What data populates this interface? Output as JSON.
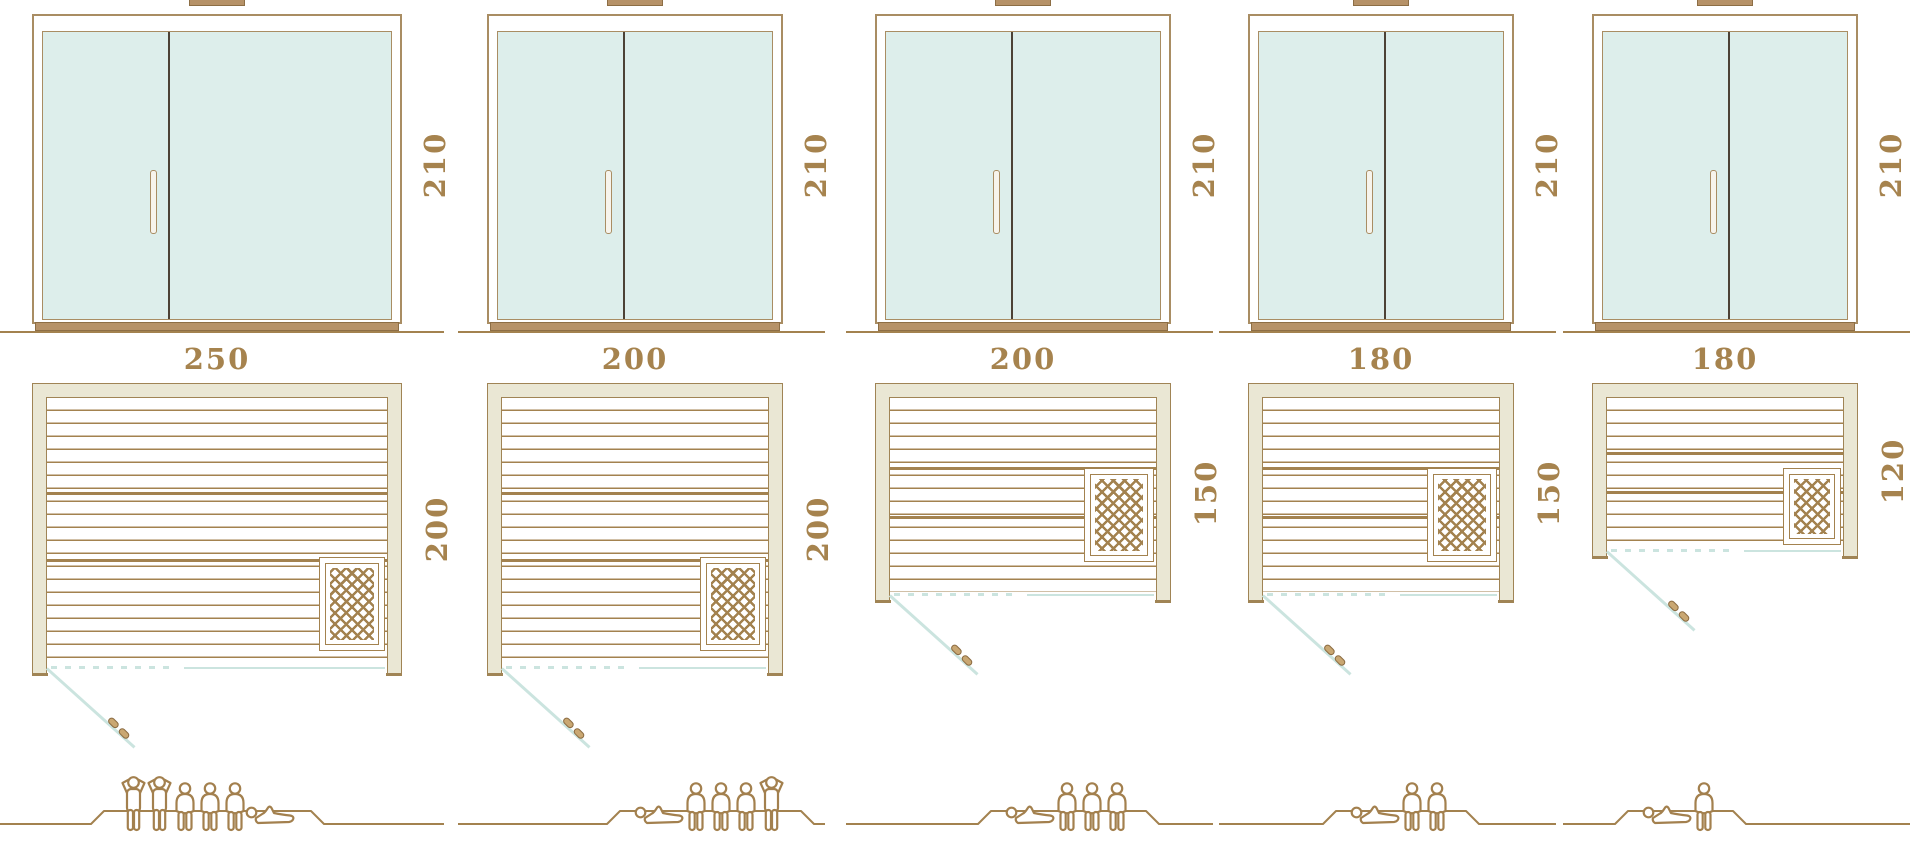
{
  "diagram": {
    "title": "Sauna cabin size comparison: front elevations, floor plans and capacity",
    "unit_of_measure": "cm"
  },
  "palette": {
    "line_brown": "#a3824f",
    "dark_brown": "#8d6e45",
    "frame_tan": "#b69268",
    "wall_beige": "#eae7d4",
    "wall_border": "#a08455",
    "glass_teal": "#ddeeeb",
    "glass_border": "#a98d63",
    "divider_dark": "#4c4236",
    "swing_teal": "#cbe4df",
    "handle_fill": "#c9a772",
    "handle_border": "#8a6a40",
    "dimension_text": "#a6834e",
    "people_outline": "#a3804e",
    "background": "#ffffff"
  },
  "units": [
    {
      "id": "sauna-250x200",
      "elevation_height_label": "210",
      "plan_width_label": "250",
      "plan_depth_label": "200",
      "width_cm": 250,
      "depth_cm": 200,
      "height_cm": 210,
      "heater_position": "bottom-right",
      "capacity_total": 6,
      "capacity_figures": [
        "standing",
        "standing",
        "sitting",
        "sitting",
        "sitting",
        "lying"
      ]
    },
    {
      "id": "sauna-200x200",
      "elevation_height_label": "210",
      "plan_width_label": "200",
      "plan_depth_label": "200",
      "width_cm": 200,
      "depth_cm": 200,
      "height_cm": 210,
      "heater_position": "bottom-right",
      "capacity_total": 5,
      "capacity_figures": [
        "lying",
        "sitting",
        "sitting",
        "sitting",
        "standing"
      ]
    },
    {
      "id": "sauna-200x150",
      "elevation_height_label": "210",
      "plan_width_label": "200",
      "plan_depth_label": "150",
      "width_cm": 200,
      "depth_cm": 150,
      "height_cm": 210,
      "heater_position": "right-center",
      "capacity_total": 4,
      "capacity_figures": [
        "lying",
        "sitting",
        "sitting",
        "sitting"
      ]
    },
    {
      "id": "sauna-180x150",
      "elevation_height_label": "210",
      "plan_width_label": "180",
      "plan_depth_label": "150",
      "width_cm": 180,
      "depth_cm": 150,
      "height_cm": 210,
      "heater_position": "right-center",
      "capacity_total": 3,
      "capacity_figures": [
        "lying",
        "sitting",
        "sitting"
      ]
    },
    {
      "id": "sauna-180x120",
      "elevation_height_label": "210",
      "plan_width_label": "180",
      "plan_depth_label": "120",
      "width_cm": 180,
      "depth_cm": 120,
      "height_cm": 210,
      "heater_position": "bottom-right",
      "capacity_total": 2,
      "capacity_figures": [
        "lying",
        "sitting"
      ]
    }
  ],
  "icons": {
    "standing_figure": "standing-person-icon",
    "sitting_figure": "sitting-person-icon",
    "lying_figure": "lying-person-icon",
    "door_swing_handle": "door-handle-icon",
    "heater_grid": "sauna-heater-icon"
  }
}
